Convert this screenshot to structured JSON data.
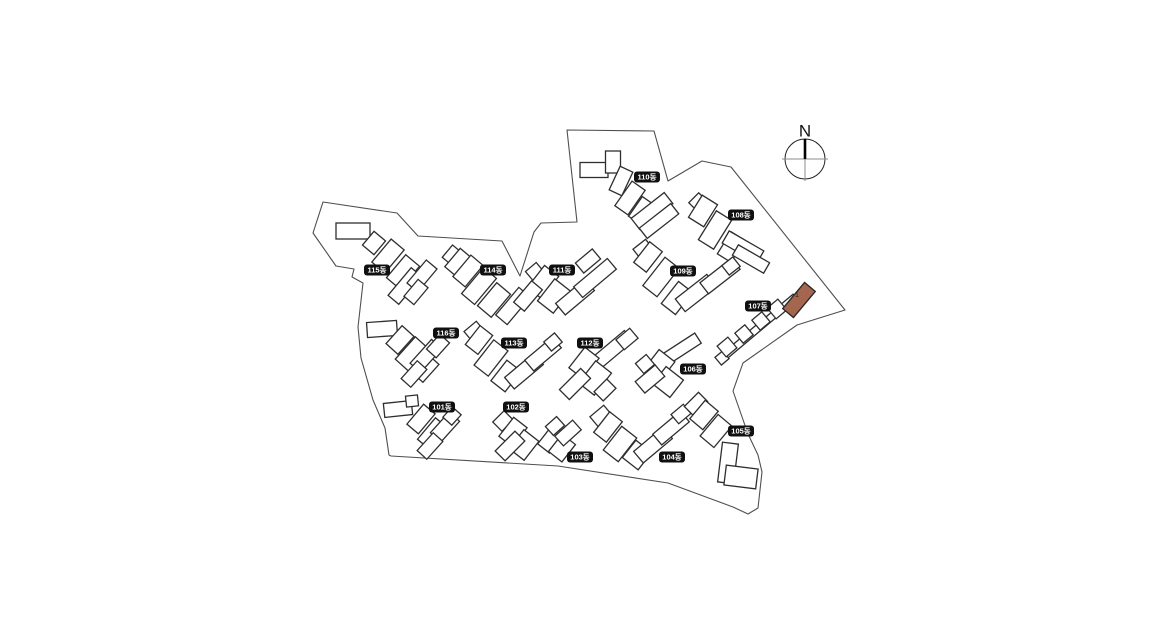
{
  "canvas": {
    "width": 1160,
    "height": 640,
    "background": "#ffffff"
  },
  "colors": {
    "building_fill": "#ffffff",
    "building_stroke": "#2e2e2e",
    "boundary_stroke": "#4f4f4f",
    "label_bg": "#101010",
    "label_text_color": "#ffffff",
    "highlight_fill": "#a5664f",
    "highlight_stroke": "#262626",
    "highlight_text_color": "#30201a",
    "compass_axis": "#8c8c8c",
    "compass_north": "#000000"
  },
  "compass": {
    "label": "N",
    "cx": 805,
    "cy": 159,
    "r": 20
  },
  "site_boundary": {
    "points": [
      [
        323,
        202
      ],
      [
        397,
        213
      ],
      [
        418,
        236
      ],
      [
        502,
        241
      ],
      [
        520,
        276
      ],
      [
        534,
        232
      ],
      [
        541,
        223
      ],
      [
        577,
        222
      ],
      [
        567,
        130
      ],
      [
        654,
        131
      ],
      [
        668,
        181
      ],
      [
        702,
        161
      ],
      [
        731,
        167
      ],
      [
        845,
        310
      ],
      [
        797,
        325
      ],
      [
        743,
        363
      ],
      [
        733,
        391
      ],
      [
        748,
        434
      ],
      [
        758,
        455
      ],
      [
        762,
        472
      ],
      [
        758,
        508
      ],
      [
        748,
        514
      ],
      [
        733,
        507
      ],
      [
        668,
        483
      ],
      [
        558,
        466
      ],
      [
        391,
        456
      ],
      [
        389,
        455
      ],
      [
        385,
        428
      ],
      [
        373,
        400
      ],
      [
        361,
        358
      ],
      [
        358,
        327
      ],
      [
        363,
        283
      ],
      [
        352,
        277
      ],
      [
        354,
        269
      ],
      [
        336,
        266
      ],
      [
        313,
        233
      ]
    ]
  },
  "buildings": [
    {
      "id": "101",
      "label": "101동",
      "label_cx": 442,
      "label_cy": 407,
      "footprint": [
        [
          398,
          409,
          28,
          14,
          -6
        ],
        [
          412,
          401,
          12,
          11,
          -6
        ],
        [
          421,
          419,
          15,
          26,
          40
        ],
        [
          433,
          434,
          17,
          28,
          40
        ],
        [
          445,
          427,
          28,
          14,
          -48
        ],
        [
          430,
          446,
          24,
          13,
          -48
        ],
        [
          452,
          416,
          14,
          12,
          -48
        ]
      ]
    },
    {
      "id": "102",
      "label": "102동",
      "label_cx": 516,
      "label_cy": 407,
      "footprint": [
        [
          503,
          421,
          16,
          13,
          -45
        ],
        [
          513,
          432,
          17,
          24,
          38
        ],
        [
          524,
          445,
          19,
          24,
          38
        ],
        [
          510,
          446,
          28,
          14,
          -45
        ]
      ]
    },
    {
      "id": "103",
      "label": "103동",
      "label_cx": 580,
      "label_cy": 457,
      "footprint": [
        [
          551,
          439,
          15,
          24,
          38
        ],
        [
          562,
          448,
          17,
          22,
          38
        ],
        [
          568,
          433,
          24,
          13,
          -42
        ],
        [
          555,
          426,
          15,
          12,
          -42
        ]
      ]
    },
    {
      "id": "104",
      "label": "104동",
      "label_cx": 672,
      "label_cy": 457,
      "footprint": [
        [
          601,
          416,
          18,
          13,
          -40
        ],
        [
          608,
          427,
          16,
          26,
          38
        ],
        [
          620,
          444,
          19,
          30,
          38
        ],
        [
          637,
          455,
          20,
          22,
          38
        ],
        [
          653,
          445,
          38,
          15,
          -40
        ],
        [
          671,
          428,
          36,
          14,
          -40
        ],
        [
          681,
          414,
          16,
          12,
          -40
        ]
      ]
    },
    {
      "id": "105",
      "label": "105동",
      "label_cx": 741,
      "label_cy": 431,
      "footprint": [
        [
          696,
          404,
          20,
          13,
          -45
        ],
        [
          704,
          415,
          17,
          24,
          40
        ],
        [
          716,
          431,
          18,
          28,
          40
        ],
        [
          728,
          463,
          16,
          40,
          7
        ],
        [
          741,
          477,
          32,
          20,
          7
        ]
      ]
    },
    {
      "id": "106",
      "label": "106동",
      "label_cx": 693,
      "label_cy": 369,
      "footprint": [
        [
          672,
          355,
          62,
          12,
          -33
        ],
        [
          659,
          366,
          20,
          26,
          38
        ],
        [
          668,
          382,
          22,
          22,
          38
        ],
        [
          650,
          379,
          26,
          15,
          -40
        ],
        [
          645,
          364,
          14,
          13,
          -40
        ]
      ]
    },
    {
      "id": "107",
      "label": "107동",
      "label_cx": 758,
      "label_cy": 306,
      "footprint": [
        [
          757,
          329,
          100,
          7,
          -40
        ],
        [
          722,
          358,
          10,
          10,
          -40
        ],
        [
          727,
          347,
          14,
          14,
          -40
        ],
        [
          744,
          334,
          13,
          13,
          -40
        ],
        [
          761,
          321,
          13,
          13,
          -40
        ],
        [
          777,
          309,
          14,
          14,
          -40
        ]
      ]
    },
    {
      "id": "108",
      "label": "108동",
      "label_cx": 741,
      "label_cy": 215,
      "footprint": [
        [
          698,
          202,
          14,
          12,
          -45
        ],
        [
          703,
          211,
          18,
          26,
          32
        ],
        [
          715,
          230,
          18,
          34,
          32
        ],
        [
          731,
          247,
          16,
          26,
          32
        ],
        [
          743,
          247,
          40,
          14,
          30
        ],
        [
          751,
          259,
          36,
          12,
          30
        ]
      ]
    },
    {
      "id": "109",
      "label": "109동",
      "label_cx": 683,
      "label_cy": 271,
      "footprint": [
        [
          643,
          249,
          16,
          12,
          -38
        ],
        [
          648,
          257,
          16,
          26,
          38
        ],
        [
          661,
          277,
          18,
          36,
          38
        ],
        [
          677,
          298,
          18,
          28,
          38
        ],
        [
          696,
          293,
          40,
          16,
          -38
        ],
        [
          720,
          276,
          40,
          14,
          -38
        ],
        [
          731,
          266,
          14,
          12,
          -38
        ]
      ]
    },
    {
      "id": "110",
      "label": "110동",
      "label_cx": 647,
      "label_cy": 177,
      "footprint": [
        [
          594,
          170,
          28,
          15,
          0
        ],
        [
          613,
          162,
          15,
          22,
          0
        ],
        [
          621,
          181,
          14,
          26,
          25
        ],
        [
          630,
          198,
          16,
          30,
          35
        ],
        [
          642,
          211,
          16,
          24,
          35
        ],
        [
          652,
          211,
          42,
          14,
          -38
        ],
        [
          659,
          221,
          40,
          13,
          -38
        ]
      ]
    },
    {
      "id": "111",
      "label": "111동",
      "label_cx": 562,
      "label_cy": 270,
      "footprint": [
        [
          535,
          272,
          14,
          13,
          -40
        ],
        [
          543,
          282,
          18,
          28,
          38
        ],
        [
          554,
          296,
          20,
          28,
          38
        ],
        [
          575,
          297,
          38,
          15,
          -40
        ],
        [
          595,
          278,
          44,
          14,
          -40
        ],
        [
          588,
          261,
          22,
          13,
          -40
        ]
      ]
    },
    {
      "id": "112",
      "label": "112동",
      "label_cx": 590,
      "label_cy": 343,
      "footprint": [
        [
          612,
          350,
          44,
          14,
          -40
        ],
        [
          627,
          339,
          18,
          13,
          -40
        ],
        [
          584,
          363,
          18,
          26,
          38
        ],
        [
          595,
          378,
          20,
          28,
          38
        ],
        [
          575,
          384,
          30,
          14,
          -45
        ],
        [
          605,
          390,
          18,
          13,
          -45
        ]
      ]
    },
    {
      "id": "113",
      "label": "113동",
      "label_cx": 514,
      "label_cy": 343,
      "footprint": [
        [
          474,
          331,
          16,
          12,
          -40
        ],
        [
          479,
          340,
          16,
          24,
          38
        ],
        [
          491,
          358,
          18,
          32,
          38
        ],
        [
          506,
          376,
          18,
          26,
          38
        ],
        [
          524,
          371,
          38,
          15,
          -40
        ],
        [
          543,
          354,
          36,
          14,
          -40
        ],
        [
          553,
          342,
          14,
          12,
          -40
        ]
      ]
    },
    {
      "id": "114",
      "label": "114동",
      "label_cx": 493,
      "label_cy": 270,
      "footprint": [
        [
          452,
          255,
          16,
          12,
          -50
        ],
        [
          459,
          263,
          17,
          24,
          40
        ],
        [
          468,
          271,
          28,
          16,
          -50
        ],
        [
          479,
          286,
          17,
          34,
          40
        ],
        [
          494,
          300,
          18,
          30,
          40
        ],
        [
          513,
          306,
          36,
          15,
          -50
        ],
        [
          528,
          296,
          28,
          14,
          -50
        ]
      ]
    },
    {
      "id": "115",
      "label": "115동",
      "label_cx": 377,
      "label_cy": 270,
      "footprint": [
        [
          353,
          231,
          34,
          16,
          0
        ],
        [
          374,
          243,
          15,
          18,
          40
        ],
        [
          388,
          256,
          17,
          30,
          40
        ],
        [
          403,
          272,
          18,
          30,
          40
        ],
        [
          405,
          286,
          36,
          14,
          -50
        ],
        [
          422,
          276,
          30,
          14,
          -50
        ],
        [
          416,
          292,
          22,
          13,
          -50
        ]
      ]
    },
    {
      "id": "116",
      "label": "116동",
      "label_cx": 446,
      "label_cy": 333,
      "footprint": [
        [
          382,
          329,
          30,
          15,
          -4
        ],
        [
          400,
          340,
          16,
          24,
          42
        ],
        [
          412,
          354,
          18,
          30,
          42
        ],
        [
          425,
          368,
          16,
          24,
          42
        ],
        [
          426,
          356,
          32,
          14,
          -48
        ],
        [
          438,
          346,
          20,
          13,
          -48
        ],
        [
          414,
          374,
          24,
          13,
          -48
        ]
      ]
    }
  ],
  "highlighted_unit": {
    "building_id": "107",
    "label": "1",
    "rect": [
      799,
      300,
      34,
      14,
      -50
    ],
    "text_x": 797,
    "text_y": 295
  }
}
